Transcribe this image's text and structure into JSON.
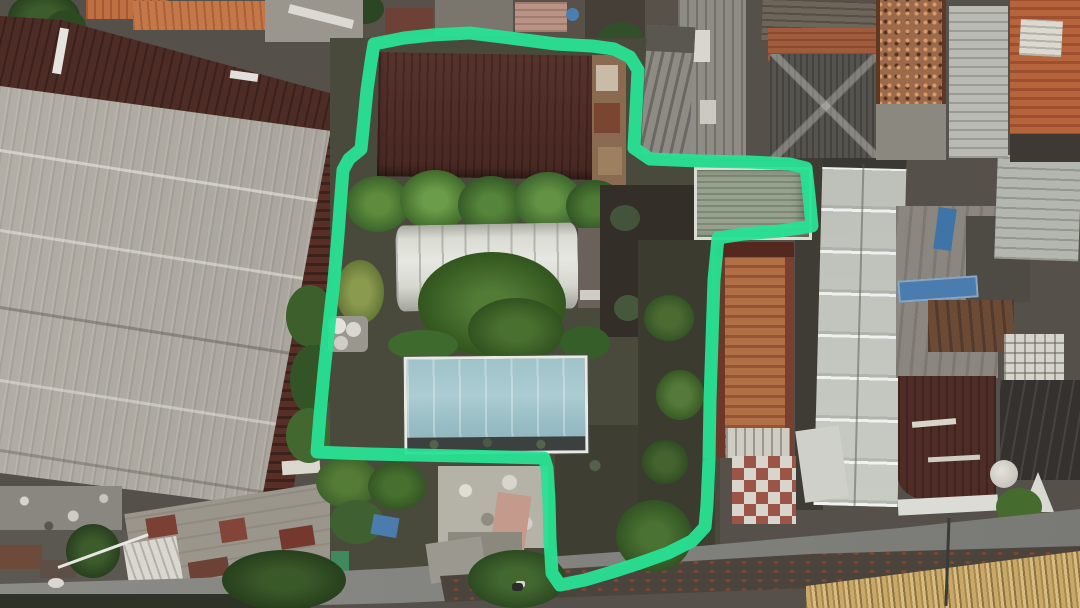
{
  "annotation": {
    "label": "property-boundary",
    "color": "#27E194",
    "stroke_width": 13,
    "opacity": 0.95,
    "boundary_points": [
      [
        374,
        44
      ],
      [
        404,
        38
      ],
      [
        432,
        35
      ],
      [
        470,
        33
      ],
      [
        510,
        38
      ],
      [
        556,
        44
      ],
      [
        592,
        46
      ],
      [
        614,
        49
      ],
      [
        630,
        57
      ],
      [
        638,
        70
      ],
      [
        636,
        110
      ],
      [
        634,
        148
      ],
      [
        650,
        159
      ],
      [
        700,
        161
      ],
      [
        750,
        162
      ],
      [
        790,
        164
      ],
      [
        806,
        168
      ],
      [
        809,
        195
      ],
      [
        812,
        226
      ],
      [
        780,
        231
      ],
      [
        744,
        234
      ],
      [
        718,
        238
      ],
      [
        714,
        280
      ],
      [
        712,
        340
      ],
      [
        710,
        400
      ],
      [
        709,
        460
      ],
      [
        707,
        505
      ],
      [
        705,
        527
      ],
      [
        692,
        541
      ],
      [
        668,
        553
      ],
      [
        640,
        563
      ],
      [
        612,
        572
      ],
      [
        585,
        580
      ],
      [
        560,
        585
      ],
      [
        552,
        573
      ],
      [
        550,
        540
      ],
      [
        549,
        500
      ],
      [
        547,
        468
      ],
      [
        544,
        458
      ],
      [
        505,
        457
      ],
      [
        460,
        456
      ],
      [
        415,
        455
      ],
      [
        370,
        454
      ],
      [
        340,
        453
      ],
      [
        317,
        452
      ],
      [
        320,
        415
      ],
      [
        324,
        372
      ],
      [
        329,
        325
      ],
      [
        334,
        280
      ],
      [
        338,
        235
      ],
      [
        341,
        195
      ],
      [
        343,
        170
      ],
      [
        349,
        159
      ],
      [
        361,
        149
      ],
      [
        364,
        120
      ],
      [
        367,
        90
      ],
      [
        371,
        62
      ],
      [
        374,
        44
      ]
    ]
  },
  "palette": {
    "annotation_green": "#27E194",
    "warehouse_gray": "#aaa69e",
    "maroon_band": "#4e2c26",
    "maroon_tile": "#572f27",
    "maroon_roof": "#4f2d27",
    "orange_tile": "#bf7042",
    "terracotta": "#b06f45",
    "slate": "#8e8b85",
    "barrel_white": "#dfe0da",
    "blue_roof": "#a0c4cb",
    "sage_roof": "#97a28e",
    "veg_dark": "#2f4f23",
    "veg_mid": "#47702f",
    "veg_light": "#6b9c49",
    "ground_dark": "#37322b",
    "road_gray": "#83837f",
    "bamboo_tan": "#c9a96a",
    "rubble_gray": "#b5b2a8",
    "charcoal": "#35312e",
    "gray_roof_right": "#c3c5bf",
    "white_trim": "#dcdcd6"
  }
}
